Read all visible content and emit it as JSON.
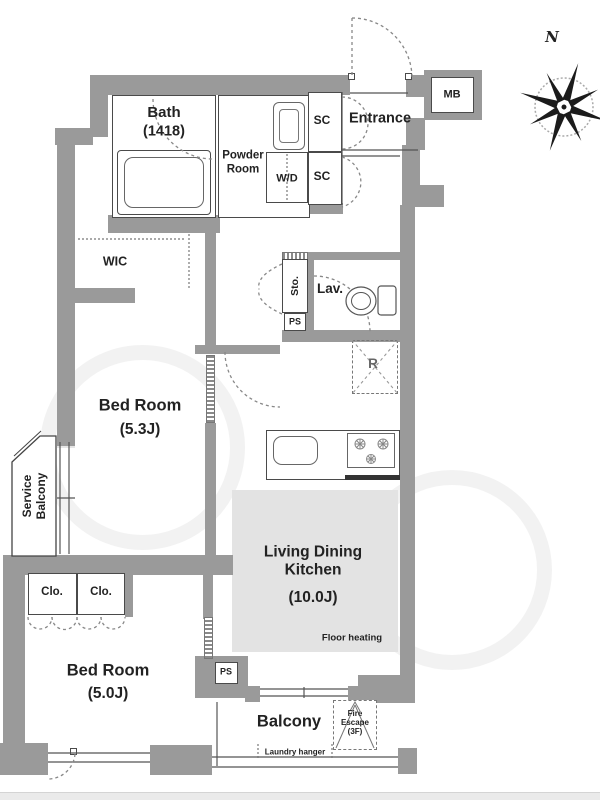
{
  "floorplan": {
    "compass": {
      "north_label": "N"
    },
    "rooms": {
      "bath": {
        "name": "Bath",
        "size": "(1418)"
      },
      "powder_room": {
        "name": "Powder Room"
      },
      "wd": {
        "name": "W/D"
      },
      "sc_upper": {
        "name": "SC"
      },
      "sc_lower": {
        "name": "SC"
      },
      "entrance": {
        "name": "Entrance"
      },
      "mb": {
        "name": "MB"
      },
      "wic": {
        "name": "WIC"
      },
      "storage": {
        "name": "Sto."
      },
      "ps_upper": {
        "name": "PS"
      },
      "lavatory": {
        "name": "Lav."
      },
      "refrigerator": {
        "name": "R"
      },
      "bedroom_1": {
        "name": "Bed Room",
        "size": "(5.3J)"
      },
      "service_balcony": {
        "name": "Service Balcony"
      },
      "closet_1": {
        "name": "Clo."
      },
      "closet_2": {
        "name": "Clo."
      },
      "bedroom_2": {
        "name": "Bed Room",
        "size": "(5.0J)"
      },
      "ps_lower": {
        "name": "PS"
      },
      "ldk": {
        "name": "Living Dining Kitchen",
        "size": "(10.0J)",
        "note": "Floor heating"
      },
      "balcony": {
        "name": "Balcony",
        "fire_escape": "Fire Escape (3F)",
        "laundry": "Laundry hanger"
      }
    },
    "colors": {
      "wall": "#9a9a9a",
      "floor_heating": "#e3e3e3",
      "line": "#4a4a4a",
      "background": "#ffffff"
    }
  }
}
